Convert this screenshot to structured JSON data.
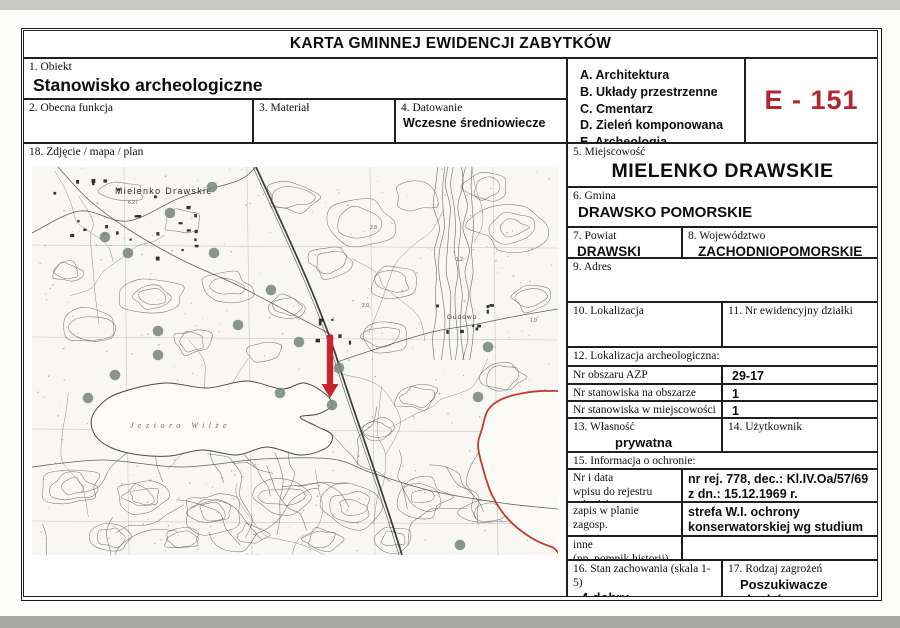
{
  "page": {
    "title": "KARTA GMINNEJ EWIDENCJI ZABYTKÓW",
    "card_number": "E - 151"
  },
  "colors": {
    "accent_red": "#b5272e",
    "map_arrow_red": "#c8242e",
    "map_outline_red": "#c23b33",
    "site_dot": "#7b897b"
  },
  "fields": {
    "obiekt": {
      "label": "1. Obiekt",
      "value": "Stanowisko archeologiczne"
    },
    "obecna_funkcja": {
      "label": "2. Obecna funkcja",
      "value": ""
    },
    "material": {
      "label": "3. Materiał",
      "value": ""
    },
    "datowanie": {
      "label": "4. Datowanie",
      "value": "Wczesne średniowiecze"
    },
    "kategorie": [
      "A. Architektura",
      "B. Układy przestrzenne",
      "C. Cmentarz",
      "D. Zieleń komponowana",
      "E. Archeologia"
    ],
    "miejscowosc": {
      "label": "5. Miejscowość",
      "value": "MIELENKO DRAWSKIE"
    },
    "gmina": {
      "label": "6. Gmina",
      "value": "DRAWSKO POMORSKIE"
    },
    "powiat": {
      "label": "7. Powiat",
      "value": "DRAWSKI"
    },
    "wojewodztwo": {
      "label": "8. Województwo",
      "value": "ZACHODNIOPOMORSKIE"
    },
    "adres": {
      "label": "9. Adres",
      "value": ""
    },
    "lokalizacja": {
      "label": "10. Lokalizacja",
      "value": ""
    },
    "nr_dzialki": {
      "label": "11. Nr ewidencyjny działki",
      "value": ""
    },
    "lokalizacja_arch": {
      "label": "12. Lokalizacja archeologiczna:",
      "rows": [
        {
          "label": "Nr obszaru AZP",
          "value": "29-17"
        },
        {
          "label": "Nr stanowiska na obszarze AZP",
          "value": "1"
        },
        {
          "label": "Nr stanowiska w miejscowości",
          "value": "1"
        }
      ]
    },
    "wlasnosc": {
      "label": "13. Własność",
      "value": "prywatna"
    },
    "uzytkownik": {
      "label": "14. Użytkownik",
      "value": ""
    },
    "ochrona": {
      "label": "15. Informacja o ochronie:",
      "rows": [
        {
          "label": "Nr i data\nwpisu do rejestru zabytków",
          "value": "nr rej. 778, dec.: Kl.IV.Oa/57/69 z dn.: 15.12.1969 r."
        },
        {
          "label": "zapis w planie zagosp.\nprzestrzennego",
          "value": "strefa W.I. ochrony konserwatorskiej wg studium"
        },
        {
          "label": "inne\n(np. pomnik historii)",
          "value": ""
        }
      ]
    },
    "stan_zachowania": {
      "label": "16. Stan zachowania (skala 1-5)",
      "value": "4-dobry"
    },
    "zagrozenia": {
      "label": "17. Rodzaj zagrożeń",
      "value": "Poszukiwacze skarbów"
    },
    "zdjecie": {
      "label": "18. Zdjęcie / mapa / plan"
    }
  },
  "map": {
    "place_labels": [
      {
        "text": "Mielenko Drawskie",
        "kind": "village",
        "x": 83,
        "y": 27
      },
      {
        "text": "Jezioro Wilże",
        "kind": "water",
        "x": 98,
        "y": 261
      },
      {
        "text": "Gudowo",
        "kind": "hamlet",
        "x": 415,
        "y": 152
      }
    ],
    "spot_heights": [
      {
        "text": "6.27",
        "x": 96,
        "y": 37
      },
      {
        "text": "2.8",
        "x": 338,
        "y": 62
      },
      {
        "text": "1.2",
        "x": 424,
        "y": 94
      },
      {
        "text": "2.0",
        "x": 330,
        "y": 140
      },
      {
        "text": "1.0",
        "x": 498,
        "y": 155
      }
    ],
    "sites": [
      [
        180,
        20
      ],
      [
        138,
        46
      ],
      [
        73,
        70
      ],
      [
        96,
        86
      ],
      [
        182,
        86
      ],
      [
        239,
        123
      ],
      [
        206,
        158
      ],
      [
        126,
        164
      ],
      [
        267,
        175
      ],
      [
        307,
        201
      ],
      [
        126,
        188
      ],
      [
        456,
        180
      ],
      [
        83,
        208
      ],
      [
        56,
        231
      ],
      [
        248,
        226
      ],
      [
        300,
        238
      ],
      [
        446,
        230
      ],
      [
        428,
        378
      ]
    ],
    "arrow": {
      "x": 298,
      "y1": 168,
      "y2": 231
    }
  }
}
